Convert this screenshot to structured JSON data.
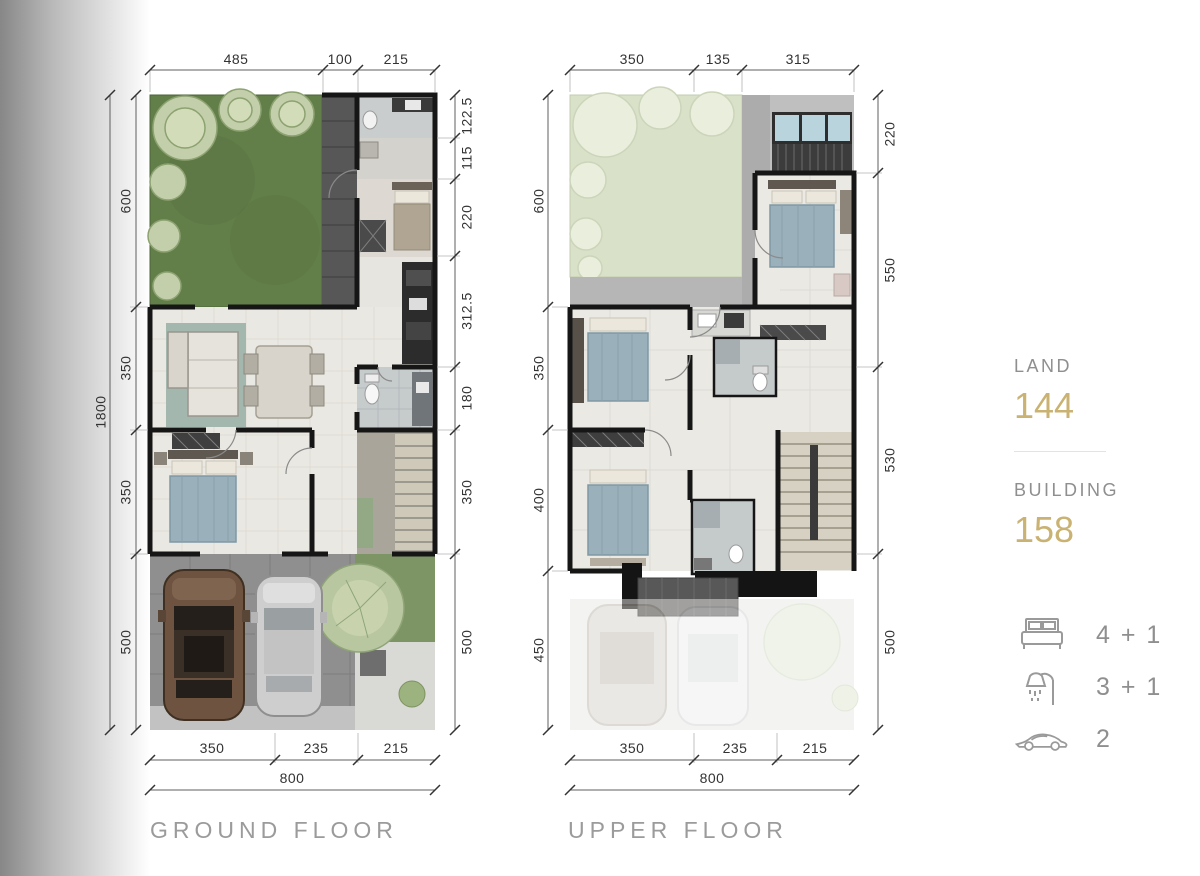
{
  "ground_floor": {
    "title": "GROUND FLOOR",
    "dims_top": [
      "485",
      "100",
      "215"
    ],
    "dim_total_height": "1800",
    "dims_left": [
      "600",
      "350",
      "350",
      "500"
    ],
    "dims_right": [
      "122.5",
      "115",
      "220",
      "312.5",
      "180",
      "350",
      "500"
    ],
    "dims_bottom": [
      "350",
      "235",
      "215"
    ],
    "dim_total_width": "800"
  },
  "upper_floor": {
    "title": "UPPER FLOOR",
    "dims_top": [
      "350",
      "135",
      "315"
    ],
    "dims_left": [
      "600",
      "350",
      "400",
      "450"
    ],
    "dims_right": [
      "220",
      "550",
      "530",
      "500"
    ],
    "dims_bottom": [
      "350",
      "235",
      "215"
    ],
    "dim_total_width": "800"
  },
  "legend": {
    "land_label": "LAND",
    "land_value": "144",
    "building_label": "BUILDING",
    "building_value": "158",
    "bedrooms_value": "4 + 1",
    "bathrooms_value": "3 + 1",
    "cars_value": "2"
  },
  "colors": {
    "accent_gold": "#c9b272",
    "label_gray": "#9b9b9b",
    "wall_black": "#161616",
    "grass_green": "#637f49",
    "roof_garden_green": "#d9e1c8"
  }
}
